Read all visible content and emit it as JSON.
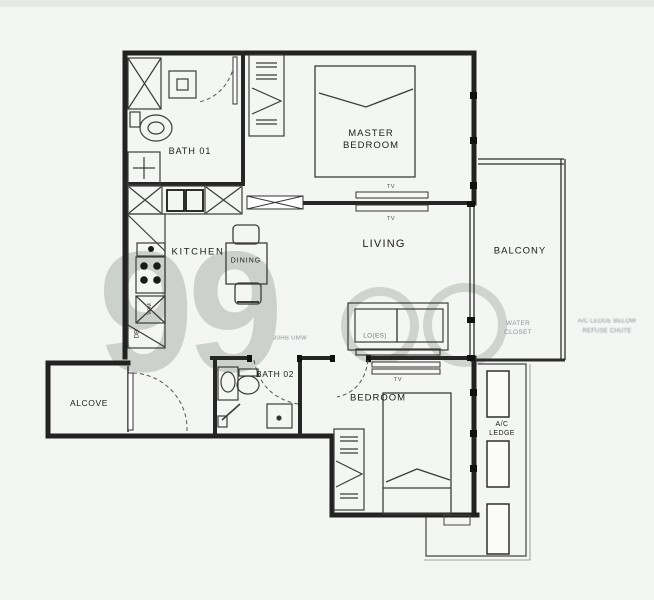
{
  "colors": {
    "background": "#f4f6f3",
    "wall": "#222222",
    "fixture": "#3c3c3c",
    "label": "#1c1c1c",
    "watermark_gray": "#7d837d"
  },
  "watermark": {
    "brand": "99"
  },
  "rooms": {
    "bath01": {
      "label": "BATH 01"
    },
    "master_bedroom": {
      "line1": "MASTER",
      "line2": "BEDROOM"
    },
    "kitchen": {
      "label": "KITCHEN"
    },
    "dining": {
      "label": "DINING"
    },
    "living": {
      "label": "LIVING"
    },
    "balcony": {
      "label": "BALCONY"
    },
    "alcove": {
      "label": "ALCOVE"
    },
    "bath02": {
      "label": "BATH 02"
    },
    "bedroom": {
      "label": "BEDROOM"
    },
    "ac_ledge": {
      "line1": "A/C",
      "line2": "LEDGE"
    }
  },
  "annotations": {
    "tv_master": "TV",
    "tv_living": "TV",
    "tv_bedroom": "TV",
    "distribution_board": "DB",
    "washing_machine": "W/M",
    "hall_note": "30HB UMW",
    "sofa_note": "LO(ES)",
    "balcony_note_line1": "WATER",
    "balcony_note_line2": "CLOSET",
    "side_note_line1": "A/C LEDGE BELOW",
    "side_note_line2": "REFUSE CHUTE"
  }
}
